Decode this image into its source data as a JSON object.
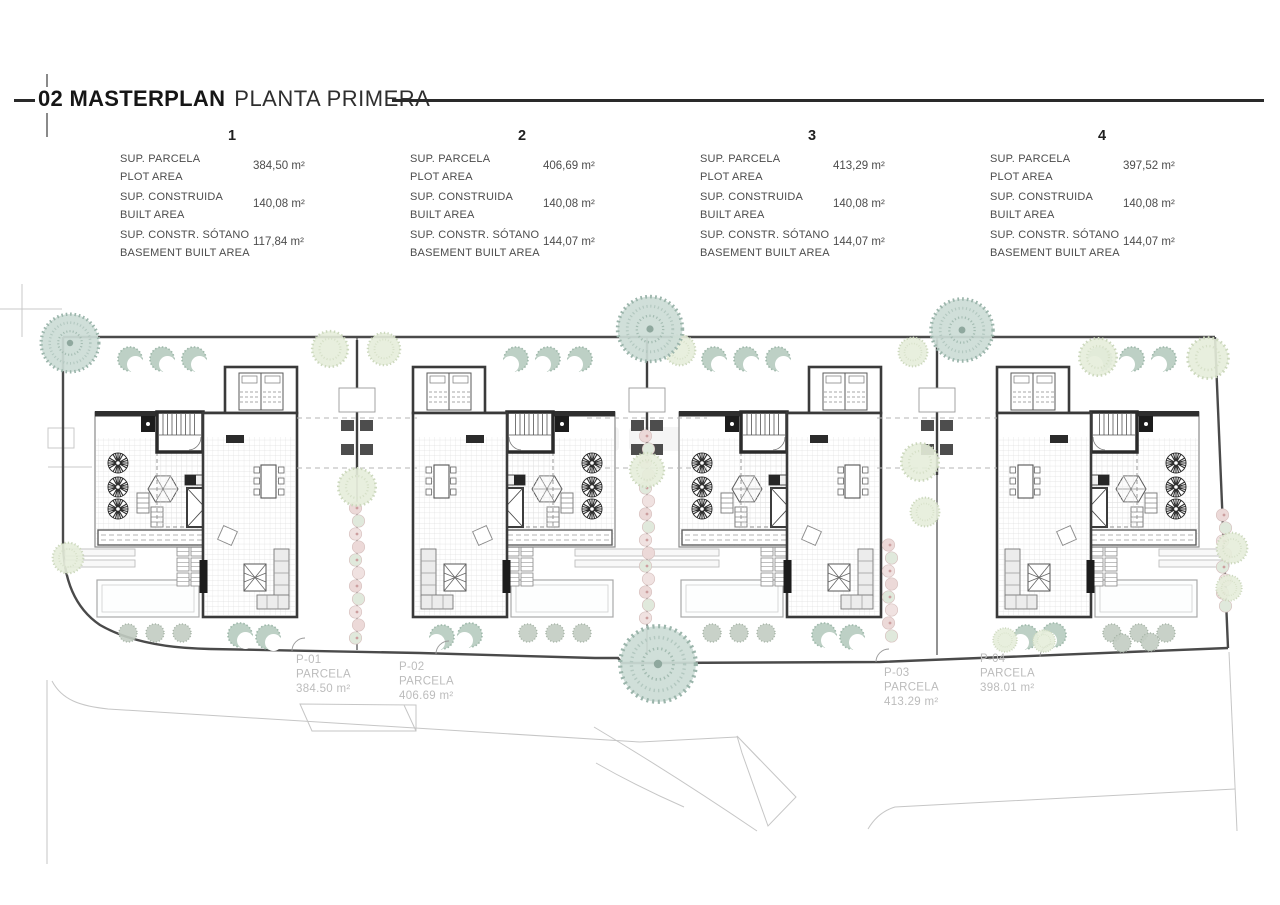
{
  "title": {
    "main": "02 MASTERPLAN",
    "sub": "PLANTA PRIMERA"
  },
  "plots": [
    {
      "number": "1",
      "rows": [
        {
          "label_es": "SUP. PARCELA",
          "label_en": "PLOT AREA",
          "value": "384,50 m²"
        },
        {
          "label_es": "SUP. CONSTRUIDA",
          "label_en": "BUILT AREA",
          "value": "140,08 m²"
        },
        {
          "label_es": "SUP. CONSTR. SÓTANO",
          "label_en": "BASEMENT BUILT AREA",
          "value": "117,84 m²"
        }
      ]
    },
    {
      "number": "2",
      "rows": [
        {
          "label_es": "SUP. PARCELA",
          "label_en": "PLOT AREA",
          "value": "406,69 m²"
        },
        {
          "label_es": "SUP. CONSTRUIDA",
          "label_en": "BUILT AREA",
          "value": "140,08 m²"
        },
        {
          "label_es": "SUP. CONSTR. SÓTANO",
          "label_en": "BASEMENT BUILT AREA",
          "value": "144,07 m²"
        }
      ]
    },
    {
      "number": "3",
      "rows": [
        {
          "label_es": "SUP. PARCELA",
          "label_en": "PLOT AREA",
          "value": "413,29 m²"
        },
        {
          "label_es": "SUP. CONSTRUIDA",
          "label_en": "BUILT AREA",
          "value": "140,08 m²"
        },
        {
          "label_es": "SUP. CONSTR. SÓTANO",
          "label_en": "BASEMENT BUILT AREA",
          "value": "144,07 m²"
        }
      ]
    },
    {
      "number": "4",
      "rows": [
        {
          "label_es": "SUP. PARCELA",
          "label_en": "PLOT AREA",
          "value": "397,52 m²"
        },
        {
          "label_es": "SUP. CONSTRUIDA",
          "label_en": "BUILT AREA",
          "value": "140,08 m²"
        },
        {
          "label_es": "SUP. CONSTR. SÓTANO",
          "label_en": "BASEMENT BUILT AREA",
          "value": "144,07 m²"
        }
      ]
    }
  ],
  "site_parcels": [
    {
      "id": "P-01",
      "label": "PARCELA",
      "area": "384.50 m²"
    },
    {
      "id": "P-02",
      "label": "PARCELA",
      "area": "406.69 m²"
    },
    {
      "id": "P-03",
      "label": "PARCELA",
      "area": "413.29 m²"
    },
    {
      "id": "P-04",
      "label": "PARCELA",
      "area": "398.01 m²"
    }
  ],
  "colors": {
    "line_dark": "#3c3c3c",
    "tree_teal": "#ccdcd6",
    "tree_pale": "#e6edda",
    "hedge_pink": "#ecd9d8",
    "label_gray": "#bcbcbc"
  }
}
